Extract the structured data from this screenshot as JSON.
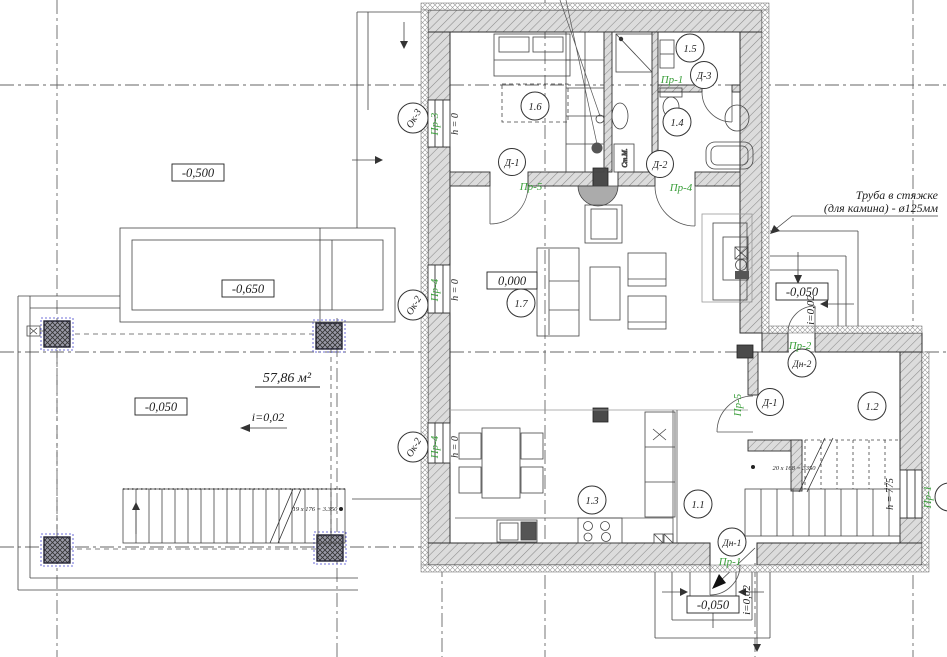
{
  "meta": {
    "type": "architectural floor plan, ground floor"
  },
  "colors": {
    "label_green": "#3a9e3a",
    "column_blue": "#4444bb",
    "line": "#333333",
    "wall_fill": "#dcdcdc"
  },
  "rooms": [
    {
      "label": "1.1"
    },
    {
      "label": "1.2"
    },
    {
      "label": "1.3"
    },
    {
      "label": "1.4"
    },
    {
      "label": "1.5"
    },
    {
      "label": "1.6"
    },
    {
      "label": "1.7"
    }
  ],
  "levels": {
    "site": "-0,500",
    "ramp": "-0,650",
    "terrace": "-0,050",
    "floor": "0,000",
    "right_porch": "-0,050",
    "entry_porch": "-0,050"
  },
  "terrace": {
    "area": "57,86 м²",
    "slope": "i=0,02",
    "stair_formula": "19 х 176 = 3.350"
  },
  "slopes": {
    "right_porch": "i=0,02",
    "entry_porch": "i=0,02"
  },
  "internal_stair_formula": "20 х 168 = 3350",
  "note": {
    "line1": "Труба в стяжке",
    "line2": "(для камина) - ø125мм"
  },
  "door_tags": {
    "bedroom": "Д-1",
    "bathroom": "Д-2",
    "storage": "Д-3",
    "stair_room": "Д-1",
    "entry": "Дн-1",
    "porch": "Дн-2"
  },
  "opening_tags": {
    "bedroom": "Пр-5",
    "bathroom": "Пр-4",
    "storage": "Пр-1",
    "stair_room": "Пр-5",
    "entry": "Пр-1",
    "porch": "Пр-2",
    "window_top": "Пр-3",
    "window_mid": "Пр-4",
    "window_bottom": "Пр-4",
    "window_right": "Пр-1"
  },
  "window_tags": {
    "top": "Ок-3",
    "mid": "Ок-2",
    "bottom": "Ок-2"
  },
  "heights": {
    "window_top": "h = 0",
    "window_mid": "h = 0",
    "window_bottom": "h = 0",
    "window_right": "h = 775"
  },
  "labels": {
    "washing_machine": "Ст.М."
  }
}
